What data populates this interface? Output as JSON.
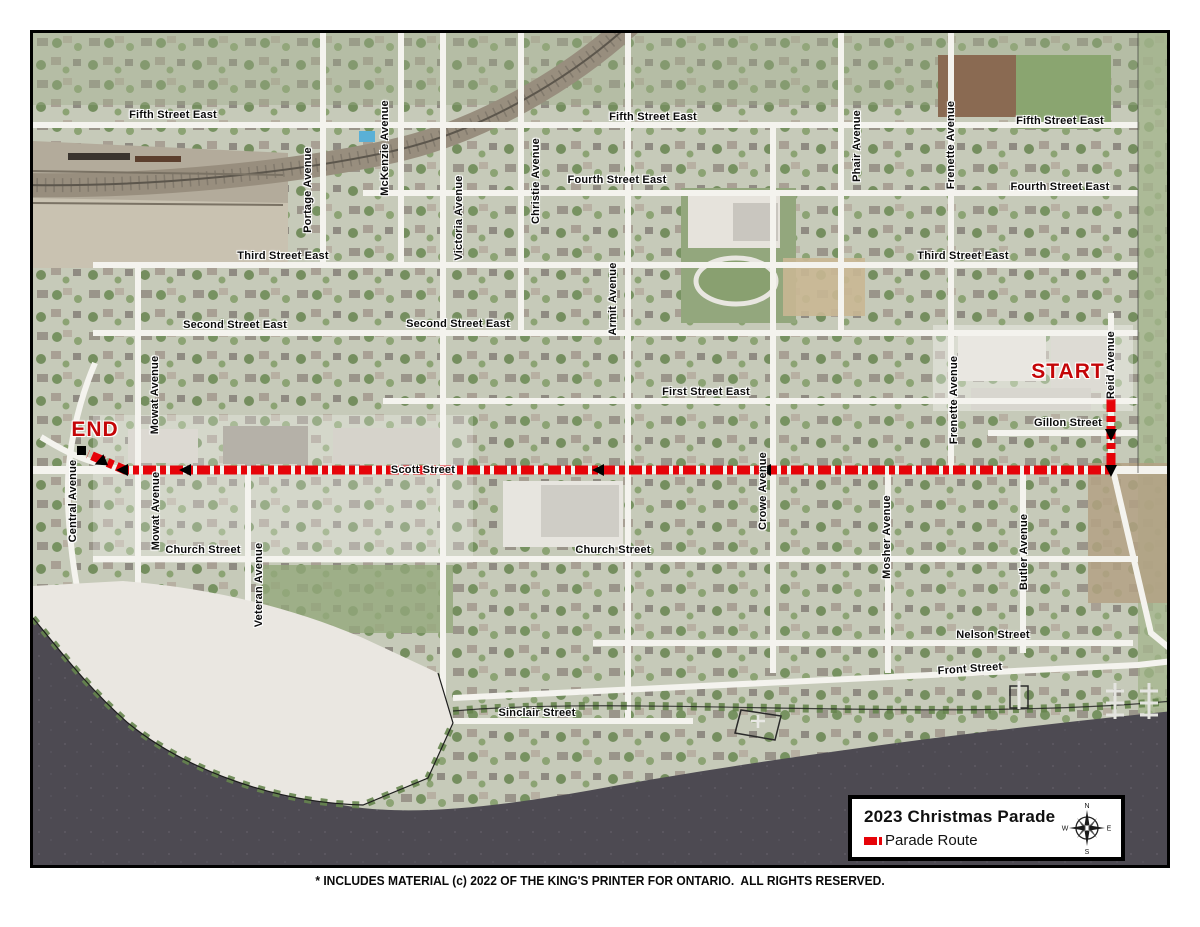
{
  "page": {
    "caption": "* INCLUDES MATERIAL (c) 2022 OF THE KING'S PRINTER FOR ONTARIO.  ALL RIGHTS RESERVED."
  },
  "map": {
    "route": {
      "color": "#e60309",
      "start_label": "START",
      "end_label": "END"
    },
    "labels": [
      {
        "text": "Fifth Street East",
        "orient": "h",
        "x": 140,
        "y": 82
      },
      {
        "text": "Fifth Street East",
        "orient": "h",
        "x": 620,
        "y": 84
      },
      {
        "text": "Fifth Street East",
        "orient": "h",
        "x": 1027,
        "y": 88
      },
      {
        "text": "Fourth Street East",
        "orient": "h",
        "x": 584,
        "y": 147
      },
      {
        "text": "Fourth Street East",
        "orient": "h",
        "x": 1027,
        "y": 154
      },
      {
        "text": "Third Street East",
        "orient": "h",
        "x": 250,
        "y": 223
      },
      {
        "text": "Third Street East",
        "orient": "h",
        "x": 930,
        "y": 223
      },
      {
        "text": "Second Street East",
        "orient": "h",
        "x": 202,
        "y": 292
      },
      {
        "text": "Second Street East",
        "orient": "h",
        "x": 425,
        "y": 291
      },
      {
        "text": "First Street East",
        "orient": "h",
        "x": 673,
        "y": 359
      },
      {
        "text": "Gillon Street",
        "orient": "h",
        "x": 1035,
        "y": 390
      },
      {
        "text": "Scott Street",
        "orient": "h",
        "x": 390,
        "y": 437
      },
      {
        "text": "Church Street",
        "orient": "h",
        "x": 170,
        "y": 517
      },
      {
        "text": "Church Street",
        "orient": "h",
        "x": 580,
        "y": 517
      },
      {
        "text": "Nelson Street",
        "orient": "h",
        "x": 960,
        "y": 602
      },
      {
        "text": "Front Street",
        "orient": "h",
        "x": 937,
        "y": 636,
        "rot": -4
      },
      {
        "text": "Sinclair Street",
        "orient": "h",
        "x": 504,
        "y": 680
      },
      {
        "text": "Portage Avenue",
        "orient": "v",
        "x": 275,
        "y": 157
      },
      {
        "text": "McKenzie Avenue",
        "orient": "v",
        "x": 352,
        "y": 115
      },
      {
        "text": "Victoria Avenue",
        "orient": "v",
        "x": 426,
        "y": 185
      },
      {
        "text": "Christie Avenue",
        "orient": "v",
        "x": 503,
        "y": 148
      },
      {
        "text": "Armit Avenue",
        "orient": "v",
        "x": 580,
        "y": 266
      },
      {
        "text": "Phair Avenue",
        "orient": "v",
        "x": 824,
        "y": 113
      },
      {
        "text": "Frenette Avenue",
        "orient": "v",
        "x": 918,
        "y": 112
      },
      {
        "text": "Frenette Avenue",
        "orient": "v",
        "x": 921,
        "y": 367
      },
      {
        "text": "Reid Avenue",
        "orient": "v",
        "x": 1078,
        "y": 332
      },
      {
        "text": "Mowat Avenue",
        "orient": "v",
        "x": 122,
        "y": 362
      },
      {
        "text": "Mowat Avenue",
        "orient": "v",
        "x": 123,
        "y": 478
      },
      {
        "text": "Central Avenue",
        "orient": "v",
        "x": 40,
        "y": 468
      },
      {
        "text": "Veteran Avenue",
        "orient": "v",
        "x": 226,
        "y": 552
      },
      {
        "text": "Crowe Avenue",
        "orient": "v",
        "x": 730,
        "y": 458
      },
      {
        "text": "Mosher Avenue",
        "orient": "v",
        "x": 854,
        "y": 504
      },
      {
        "text": "Butler Avenue",
        "orient": "v",
        "x": 991,
        "y": 519
      }
    ]
  },
  "legend": {
    "title": "2023 Christmas Parade",
    "items": [
      {
        "label": "Parade Route",
        "swatch_color": "#e60309"
      }
    ],
    "compass": {
      "n": "N",
      "e": "E",
      "s": "S",
      "w": "W"
    }
  }
}
